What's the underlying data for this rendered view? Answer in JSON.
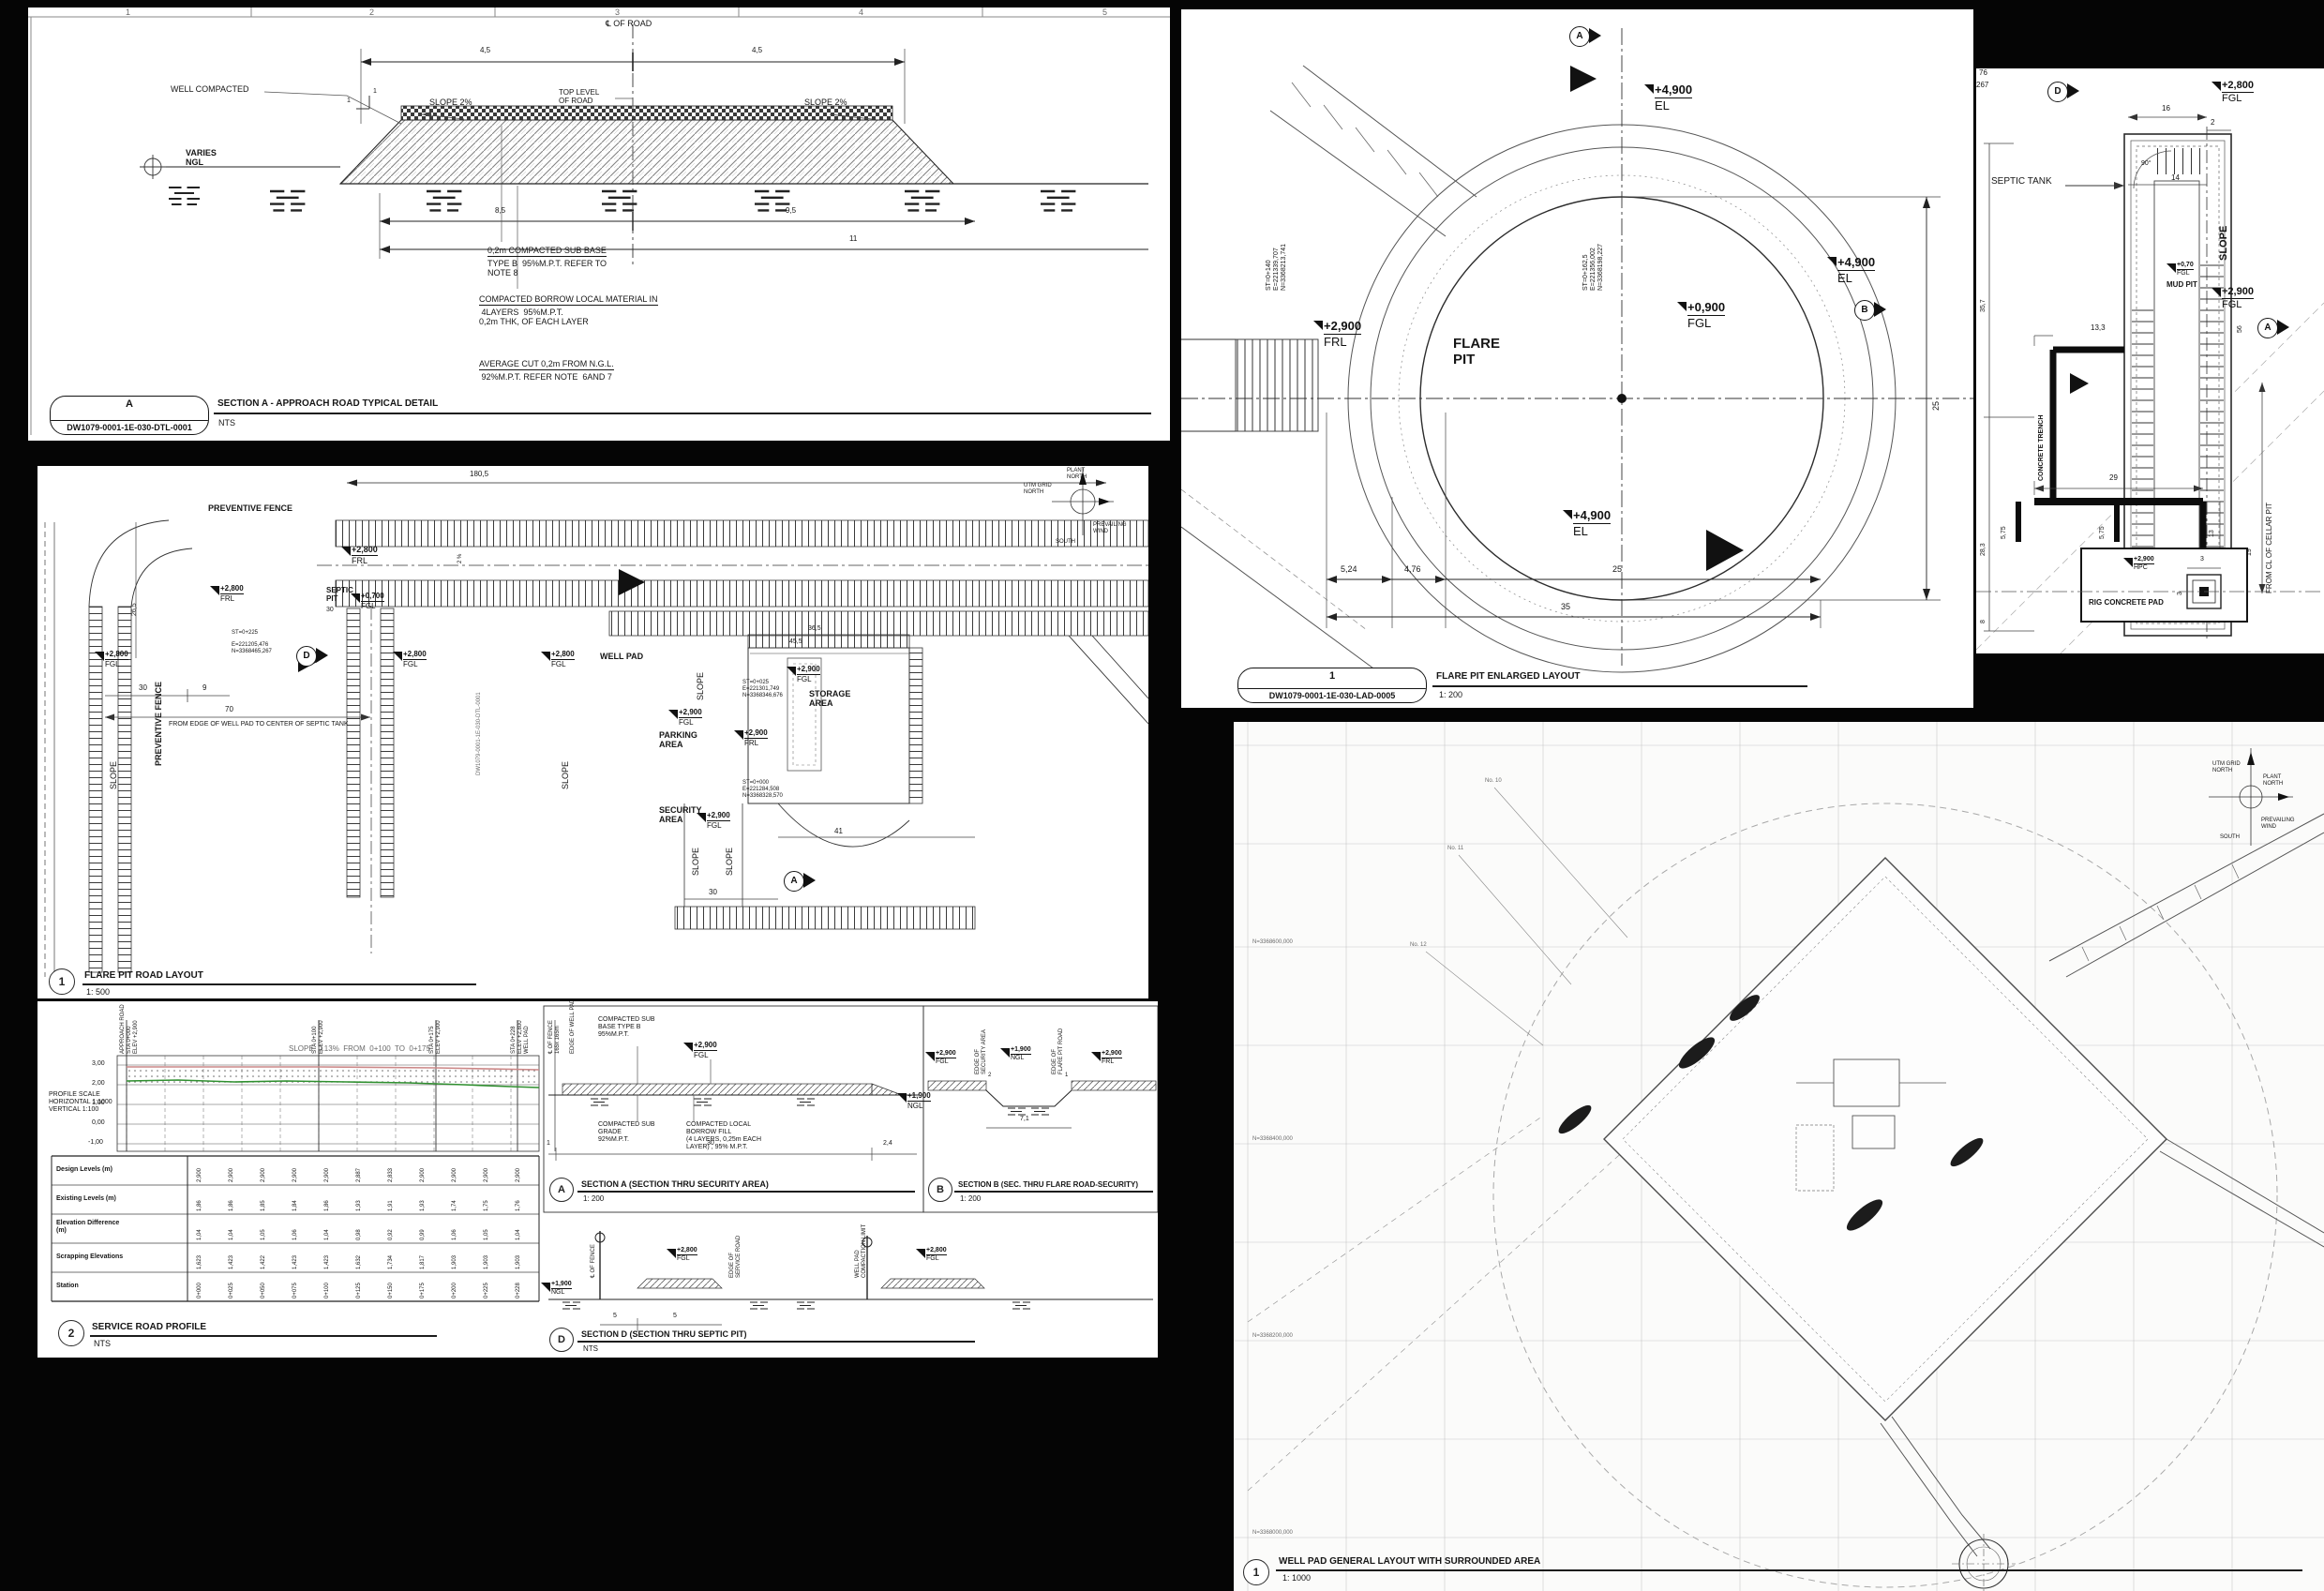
{
  "common": {
    "fgl": "FGL",
    "frl": "FRL",
    "ngl": "NGL",
    "el": "EL",
    "hpc": "HPC",
    "slope": "SLOPE",
    "v049": "+4,900",
    "v029": "+2,900",
    "v028": "+2,800",
    "v009": "+0,900",
    "v0700": "+0,700",
    "v0070": "+0,70",
    "v019": "+1,900",
    "compass": {
      "utm": "UTM GRID\nNORTH",
      "plant": "PLANT\nNORTH",
      "wind": "PREVAILING\nWIND",
      "south": "SOUTH"
    }
  },
  "p1": {
    "cols": [
      "1",
      "2",
      "3",
      "4",
      "5"
    ],
    "cl_road": "℄ OF ROAD",
    "dim_45l": "4,5",
    "dim_45r": "4,5",
    "well_compacted": "WELL COMPACTED",
    "slope2l": "SLOPE 2%",
    "slope2r": "SLOPE 2%",
    "top_level": "TOP LEVEL\nOF ROAD",
    "varies": "VARIES\nNGL",
    "one_a": "1",
    "one_b": "1",
    "dim_85": "8,5",
    "dim_95": "9,5",
    "dim_11": "11",
    "note1_t": "0,2m COMPACTED SUB BASE",
    "note1_b": "TYPE B  95%M.P.T. REFER TO\nNOTE 8",
    "note2_t": "COMPACTED BORROW LOCAL MATERIAL IN",
    "note2_b": " 4LAYERS  95%M.P.T.\n0,2m THK, OF EACH LAYER",
    "note3_t": "AVERAGE CUT 0,2m FROM N.G.L.",
    "note3_b": " 92%M.P.T. REFER NOTE  6AND 7",
    "ref_letter": "A",
    "ref_num": "DW1079-0001-1E-030-DTL-0001",
    "title": "SECTION A - APPROACH ROAD TYPICAL DETAIL",
    "scale": "NTS"
  },
  "p2": {
    "marker_a": "A",
    "marker_b": "B",
    "st_left": "ST=0+140\nE=221339,707\nN=3368213,741",
    "st_center": "ST=0+162,5\nE=221356,002\nN=3368198,227",
    "flare_pit": "FLARE\nPIT",
    "dim_25v": "25",
    "dim_524": "5,24",
    "dim_476": "4,76",
    "dim_25": "25",
    "dim_35": "35",
    "ref_id": "1",
    "ref_num": "DW1079-0001-1E-030-LAD-0005",
    "title": "FLARE PIT ENLARGED LAYOUT",
    "scale": "1: 200"
  },
  "p3": {
    "frag_76": "76",
    "frag_267": "267",
    "marker_d": "D",
    "marker_a": "A",
    "septic_tank": "SEPTIC TANK",
    "mud_pit": "MUD PIT",
    "dim_16": "16",
    "dim_2": "2",
    "dim_14": "14",
    "ang_90": "90°",
    "dim_56": "56",
    "dim_133": "13,3",
    "dim_357": "35,7",
    "dim_283": "28,3",
    "dim_8": "8",
    "concrete_trench": "CONCRETE TRENCH",
    "dim_29": "29",
    "dim_575a": "5,75",
    "dim_575b": "5,75",
    "dim_13": "13",
    "dim_19": "19",
    "from_cl": "FROM CL OF CELLAR PIT",
    "rig_pad": "RIG CONCRETE PAD",
    "dim_3a": "3",
    "dim_3b": "3"
  },
  "p4": {
    "fence_h": "PREVENTIVE FENCE",
    "fence_v": "PREVENTIVE FENCE",
    "dim_1805": "180,5",
    "dim_265": "26,5",
    "slope_pct": "2 %",
    "septic_pit": "SEPTIC\nPIT",
    "st_225": "ST=0+225",
    "coord_a": "E=221205,476\nN=3368465,267",
    "well_pad": "WELL PAD",
    "dim_30a": "30",
    "dim_9": "9",
    "dim_70": "70",
    "dim_30b": "30",
    "dim_30c": "30",
    "dim_41": "41",
    "dim_455": "45,5",
    "dim_365": "36,5",
    "from_edge": "FROM EDGE OF WELL PAD TO CENTER OF SEPTIC TANK",
    "storage": "STORAGE\nAREA",
    "parking": "PARKING\nAREA",
    "security": "SECURITY\nAREA",
    "st_025": "ST=0+025\nE=221301,749\nN=3368346,676",
    "st_000": "ST=0+000\nE=221284,508\nN=3368328,570",
    "dwg_vert": "DW1079-0001-1E-030-DTL-0001",
    "marker_a": "A",
    "marker_d": "D",
    "ref_id": "1",
    "title": "FLARE PIT ROAD LAYOUT",
    "scale": "1: 500"
  },
  "p5": {
    "profile_scale": "PROFILE SCALE\nHORIZONTAL 1:1000\nVERTICAL 1:100",
    "slope_note": "SLOPE  0.13%  FROM  0+100  TO  0+175",
    "yticks": [
      "3,00",
      "2,00",
      "1,00",
      "0,00",
      "-1,00"
    ],
    "sta_labels": [
      "APPROACH ROAD\nSTA 0+000\nELEV +2,900",
      "STA 0+100\nELEV +2,900",
      "STA 0+175\nELEV +2,900",
      "STA 0+228\nELEV +2,800\nWELL PAD"
    ],
    "fence_lbl": "℄ OF FENCE\n165x 165m",
    "edge_wp": "EDGE OF WELL PAD",
    "table": {
      "rows": [
        "Design Levels (m)",
        "Existing Levels (m)",
        "Elevation Difference\n(m)",
        "Scrapping Elevations",
        "Station"
      ],
      "design": [
        "2,900",
        "2,900",
        "2,900",
        "2,900",
        "2,900",
        "2,887",
        "2,833",
        "2,900",
        "2,900",
        "2,900",
        "2,900"
      ],
      "existing": [
        "1,86",
        "1,86",
        "1,85",
        "1,84",
        "1,86",
        "1,93",
        "1,91",
        "1,93",
        "1,74",
        "1,75",
        "1,76"
      ],
      "diff": [
        "1,04",
        "1,04",
        "1,05",
        "1,06",
        "1,04",
        "0,98",
        "0,92",
        "0,99",
        "1,06",
        "1,05",
        "1,04"
      ],
      "scrap": [
        "1,623",
        "1,423",
        "1,422",
        "1,423",
        "1,423",
        "1,632",
        "1,734",
        "1,817",
        "1,903",
        "1,903",
        "1,903"
      ],
      "station": [
        "0+000",
        "0+025",
        "0+050",
        "0+075",
        "0+100",
        "0+125",
        "0+150",
        "0+175",
        "0+200",
        "0+225",
        "0+228"
      ]
    },
    "ref2": "2",
    "title2": "SERVICE ROAD PROFILE",
    "scale2": "NTS",
    "secA": {
      "note_base": "COMPACTED SUB\nBASE TYPE B\n95%M.P.T.",
      "note_grade": "COMPACTED SUB\nGRADE\n92%M.P.T.",
      "note_fill": "COMPACTED LOCAL\nBORROW FILL\n(4 LAYERS, 0,25m EACH\nLAYER) , 95% M.P.T.",
      "dim_30": "30",
      "dim_24": "2,4",
      "dim_1": "1",
      "id": "A",
      "title": "SECTION A (SECTION THRU SECURITY AREA)",
      "scale": "1: 200"
    },
    "secB": {
      "edge_sec": "EDGE OF\nSECURITY AREA",
      "edge_flare": "EDGE OF\nFLARE PIT ROAD",
      "dim_71": "7,1",
      "s2": "2",
      "s1": "1",
      "id": "B",
      "title": "SECTION B (SEC. THRU FLARE ROAD-SECURITY)",
      "scale": "1: 200"
    },
    "secD": {
      "cl_fence": "℄ OF FENCE",
      "edge_service": "EDGE OF\nSERVICE ROAD",
      "comp_limit": "WELL PAD\nCOMPACTION LIMIT",
      "dim_5a": "5",
      "dim_5b": "5",
      "id": "D",
      "title": "SECTION D (SECTION THRU SEPTIC PIT)",
      "scale": "NTS"
    }
  },
  "p6": {
    "no10": "No. 10",
    "no11": "No. 11",
    "no12": "No. 12",
    "grid_n": [
      "N=3368600,000",
      "N=3368400,000",
      "N=3368200,000",
      "N=3368000,000"
    ],
    "ref_id": "1",
    "title": "WELL PAD GENERAL LAYOUT WITH SURROUNDED AREA",
    "scale": "1: 1000"
  }
}
